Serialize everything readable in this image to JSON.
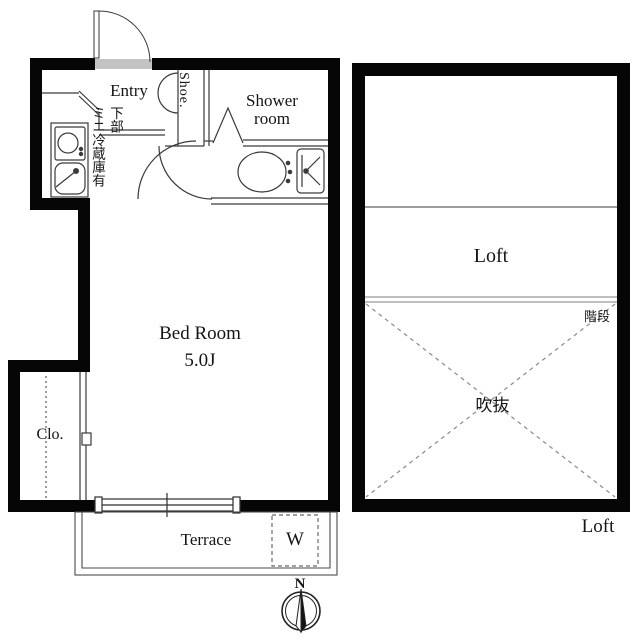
{
  "plan": {
    "main_floor": {
      "entry_label": "Entry",
      "shoe_label": "Shoe.",
      "shower_label_line1": "Shower",
      "shower_label_line2": "room",
      "fridge_note_col1": "下部",
      "fridge_note_col2": "ミニ冷蔵庫有",
      "bedroom_label": "Bed Room",
      "bedroom_size": "5.0J",
      "closet_label": "Clo.",
      "terrace_label": "Terrace",
      "washer_label": "W"
    },
    "loft_floor": {
      "loft_room_label": "Loft",
      "stairs_label": "階段",
      "void_label": "吹抜",
      "caption": "Loft"
    },
    "compass": {
      "north_label": "N"
    },
    "colors": {
      "wall": "#060606",
      "line": "#3a3a3a",
      "dash": "#7a7a7a"
    }
  }
}
